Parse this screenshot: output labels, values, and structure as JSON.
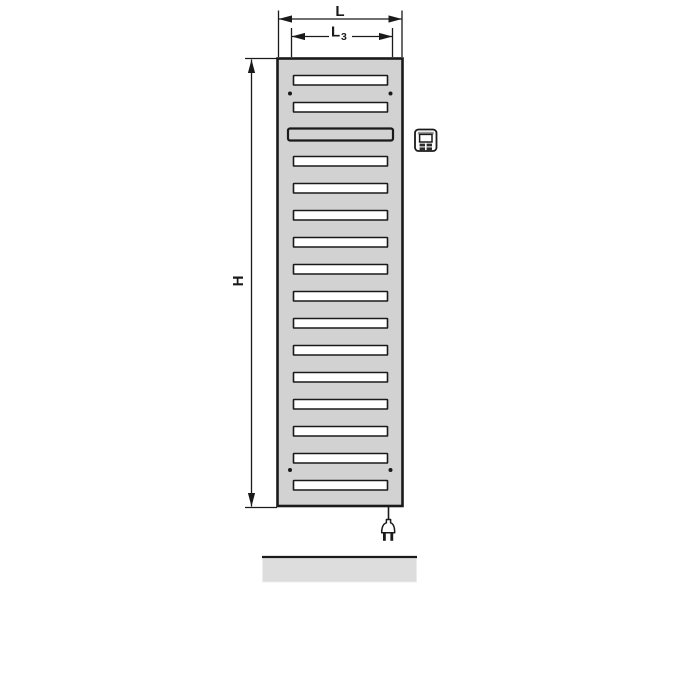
{
  "labels": {
    "total_width": "L",
    "slat_width_main": "L",
    "slat_width_sub": "3",
    "height": "H"
  },
  "colors": {
    "line": "#1a1a1a",
    "radiator_fill": "#d2d2d2",
    "slat_fill": "#ffffff",
    "floor_fill": "#dddddd",
    "icon_dark": "#2b2b2b"
  },
  "radiator": {
    "slat_count": 16,
    "wide_slat_index": 2,
    "mounting_dot_count": 4
  },
  "icons": {
    "control_unit": "control-unit-icon",
    "power_plug": "power-plug-icon"
  }
}
